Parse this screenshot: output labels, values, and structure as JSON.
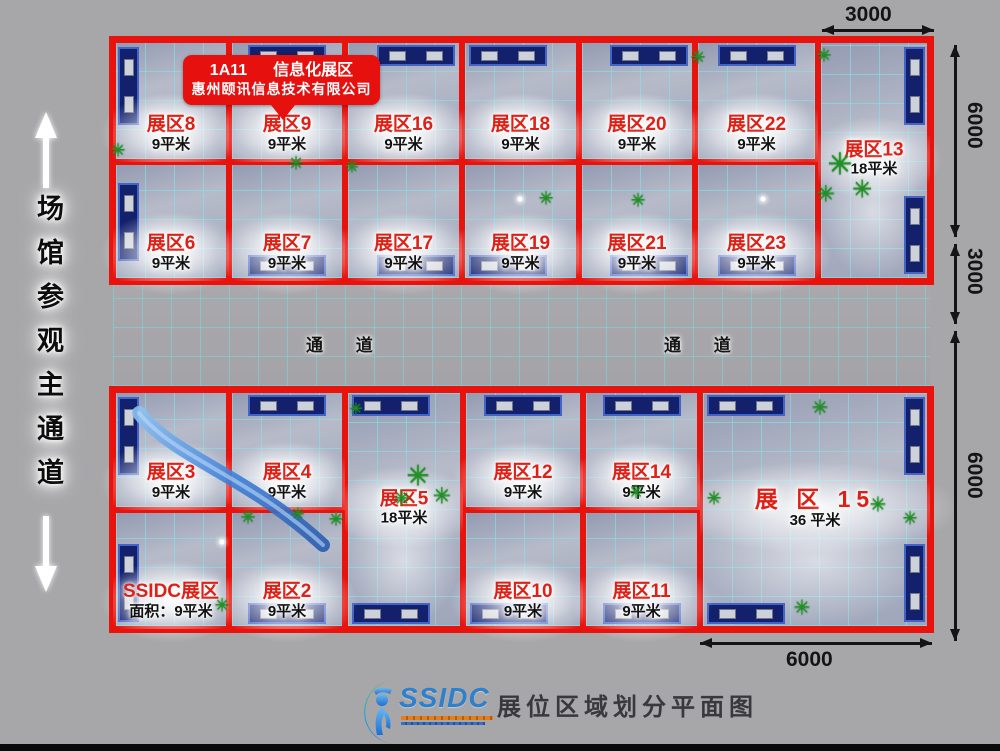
{
  "callout": {
    "code": "1A11",
    "zone": "信息化展区",
    "company": "惠州颐讯信息技术有限公司"
  },
  "left_aisle": {
    "label": "场馆参观主通道"
  },
  "aisles": {
    "left_label": "通 道",
    "right_label": "通 道"
  },
  "dimensions": {
    "top_width": "3000",
    "right_top": "6000",
    "right_middle": "3000",
    "right_bottom": "6000",
    "bottom_width": "6000"
  },
  "footer": {
    "logo_text": "SSIDC",
    "title": "展位区域划分平面图"
  },
  "colors": {
    "border_red": "#e8130d",
    "label_red": "#dd2117",
    "callout_red": "#e6100f",
    "grid_cyan": "#84e2ec",
    "desk_navy": "#13206b",
    "plant_green": "#1c9422",
    "logo_blue": "#2f80cc"
  },
  "floor": {
    "booths": [
      {
        "id": "zone-8",
        "name": "展区8",
        "area": "9平米",
        "rect": [
          113,
          40,
          116,
          122
        ],
        "label_pos": "bottom",
        "desks": [
          {
            "side": "left",
            "align": "start"
          }
        ]
      },
      {
        "id": "zone-9",
        "name": "展区9",
        "area": "9平米",
        "rect": [
          229,
          40,
          116,
          122
        ],
        "label_pos": "bottom",
        "desks": [
          {
            "side": "top",
            "align": "center"
          }
        ]
      },
      {
        "id": "zone-16",
        "name": "展区16",
        "area": "9平米",
        "rect": [
          345,
          40,
          117,
          122
        ],
        "label_pos": "bottom",
        "desks": [
          {
            "side": "top",
            "align": "end"
          }
        ]
      },
      {
        "id": "zone-18",
        "name": "展区18",
        "area": "9平米",
        "rect": [
          462,
          40,
          117,
          122
        ],
        "label_pos": "bottom",
        "desks": [
          {
            "side": "top",
            "align": "start"
          }
        ]
      },
      {
        "id": "zone-20",
        "name": "展区20",
        "area": "9平米",
        "rect": [
          579,
          40,
          116,
          122
        ],
        "label_pos": "bottom",
        "desks": [
          {
            "side": "top",
            "align": "end"
          }
        ]
      },
      {
        "id": "zone-22",
        "name": "展区22",
        "area": "9平米",
        "rect": [
          695,
          40,
          123,
          122
        ],
        "label_pos": "bottom",
        "desks": [
          {
            "side": "top",
            "align": "center"
          }
        ]
      },
      {
        "id": "zone-13",
        "name": "展区13",
        "area": "18平米",
        "rect": [
          818,
          40,
          112,
          241
        ],
        "label_pos": "center",
        "desks": [
          {
            "side": "right",
            "align": "start"
          },
          {
            "side": "right",
            "align": "end"
          }
        ]
      },
      {
        "id": "zone-6",
        "name": "展区6",
        "area": "9平米",
        "rect": [
          113,
          162,
          116,
          119
        ],
        "label_pos": "bottom",
        "desks": [
          {
            "side": "left",
            "align": "center"
          }
        ]
      },
      {
        "id": "zone-7",
        "name": "展区7",
        "area": "9平米",
        "rect": [
          229,
          162,
          116,
          119
        ],
        "label_pos": "bottom",
        "desks": [
          {
            "side": "bottom",
            "align": "center"
          }
        ]
      },
      {
        "id": "zone-17",
        "name": "展区17",
        "area": "9平米",
        "rect": [
          345,
          162,
          117,
          119
        ],
        "label_pos": "bottom",
        "desks": [
          {
            "side": "bottom",
            "align": "end"
          }
        ]
      },
      {
        "id": "zone-19",
        "name": "展区19",
        "area": "9平米",
        "rect": [
          462,
          162,
          117,
          119
        ],
        "label_pos": "bottom",
        "desks": [
          {
            "side": "bottom",
            "align": "start"
          }
        ]
      },
      {
        "id": "zone-21",
        "name": "展区21",
        "area": "9平米",
        "rect": [
          579,
          162,
          116,
          119
        ],
        "label_pos": "bottom",
        "desks": [
          {
            "side": "bottom",
            "align": "end"
          }
        ]
      },
      {
        "id": "zone-23",
        "name": "展区23",
        "area": "9平米",
        "rect": [
          695,
          162,
          123,
          119
        ],
        "label_pos": "bottom",
        "desks": [
          {
            "side": "bottom",
            "align": "center"
          }
        ]
      },
      {
        "id": "zone-3",
        "name": "展区3",
        "area": "9平米",
        "rect": [
          113,
          390,
          116,
          120
        ],
        "label_pos": "bottom",
        "desks": [
          {
            "side": "left",
            "align": "start"
          }
        ]
      },
      {
        "id": "zone-4",
        "name": "展区4",
        "area": "9平米",
        "rect": [
          229,
          390,
          116,
          120
        ],
        "label_pos": "bottom",
        "desks": [
          {
            "side": "top",
            "align": "center"
          }
        ]
      },
      {
        "id": "zone-5",
        "name": "展区5",
        "area": "18平米",
        "rect": [
          345,
          390,
          118,
          239
        ],
        "label_pos": "center",
        "desks": [
          {
            "side": "top",
            "align": "start"
          },
          {
            "side": "bottom",
            "align": "start"
          }
        ]
      },
      {
        "id": "zone-12",
        "name": "展区12",
        "area": "9平米",
        "rect": [
          463,
          390,
          120,
          120
        ],
        "label_pos": "bottom",
        "desks": [
          {
            "side": "top",
            "align": "center"
          }
        ]
      },
      {
        "id": "zone-14",
        "name": "展区14",
        "area": "9平米",
        "rect": [
          583,
          390,
          117,
          120
        ],
        "label_pos": "bottom",
        "desks": [
          {
            "side": "top",
            "align": "center"
          }
        ]
      },
      {
        "id": "zone-15",
        "name": "展 区 15",
        "area": "36 平米",
        "rect": [
          700,
          390,
          230,
          239
        ],
        "label_pos": "center",
        "big": true,
        "desks": [
          {
            "side": "top",
            "align": "start"
          },
          {
            "side": "bottom",
            "align": "start"
          },
          {
            "side": "right",
            "align": "start"
          },
          {
            "side": "right",
            "align": "end"
          }
        ]
      },
      {
        "id": "ssidc-zone",
        "name": "SSIDC展区",
        "area": "面积：9平米",
        "rect": [
          113,
          510,
          116,
          119
        ],
        "label_pos": "bottom",
        "desks": [
          {
            "side": "left",
            "align": "end"
          }
        ]
      },
      {
        "id": "zone-2",
        "name": "展区2",
        "area": "9平米",
        "rect": [
          229,
          510,
          116,
          119
        ],
        "label_pos": "bottom",
        "desks": [
          {
            "side": "bottom",
            "align": "center"
          }
        ]
      },
      {
        "id": "zone-10",
        "name": "展区10",
        "area": "9平米",
        "rect": [
          463,
          510,
          120,
          119
        ],
        "label_pos": "bottom",
        "desks": [
          {
            "side": "bottom",
            "align": "start"
          }
        ]
      },
      {
        "id": "zone-11",
        "name": "展区11",
        "area": "9平米",
        "rect": [
          583,
          510,
          117,
          119
        ],
        "label_pos": "bottom",
        "desks": [
          {
            "side": "bottom",
            "align": "center"
          }
        ]
      }
    ],
    "plants": [
      [
        118,
        150,
        18
      ],
      [
        296,
        163,
        18
      ],
      [
        352,
        168,
        16
      ],
      [
        546,
        198,
        18
      ],
      [
        638,
        200,
        18
      ],
      [
        698,
        57,
        18
      ],
      [
        824,
        55,
        18
      ],
      [
        840,
        165,
        30
      ],
      [
        862,
        190,
        24
      ],
      [
        826,
        194,
        22
      ],
      [
        356,
        410,
        16
      ],
      [
        418,
        476,
        28
      ],
      [
        442,
        496,
        22
      ],
      [
        402,
        499,
        20
      ],
      [
        248,
        517,
        18
      ],
      [
        298,
        515,
        16
      ],
      [
        336,
        519,
        18
      ],
      [
        636,
        492,
        18
      ],
      [
        820,
        408,
        20
      ],
      [
        878,
        505,
        20
      ],
      [
        910,
        518,
        18
      ],
      [
        714,
        498,
        18
      ],
      [
        802,
        608,
        20
      ],
      [
        222,
        605,
        18
      ]
    ],
    "spots": [
      [
        520,
        199
      ],
      [
        763,
        199
      ],
      [
        222,
        542
      ]
    ]
  }
}
